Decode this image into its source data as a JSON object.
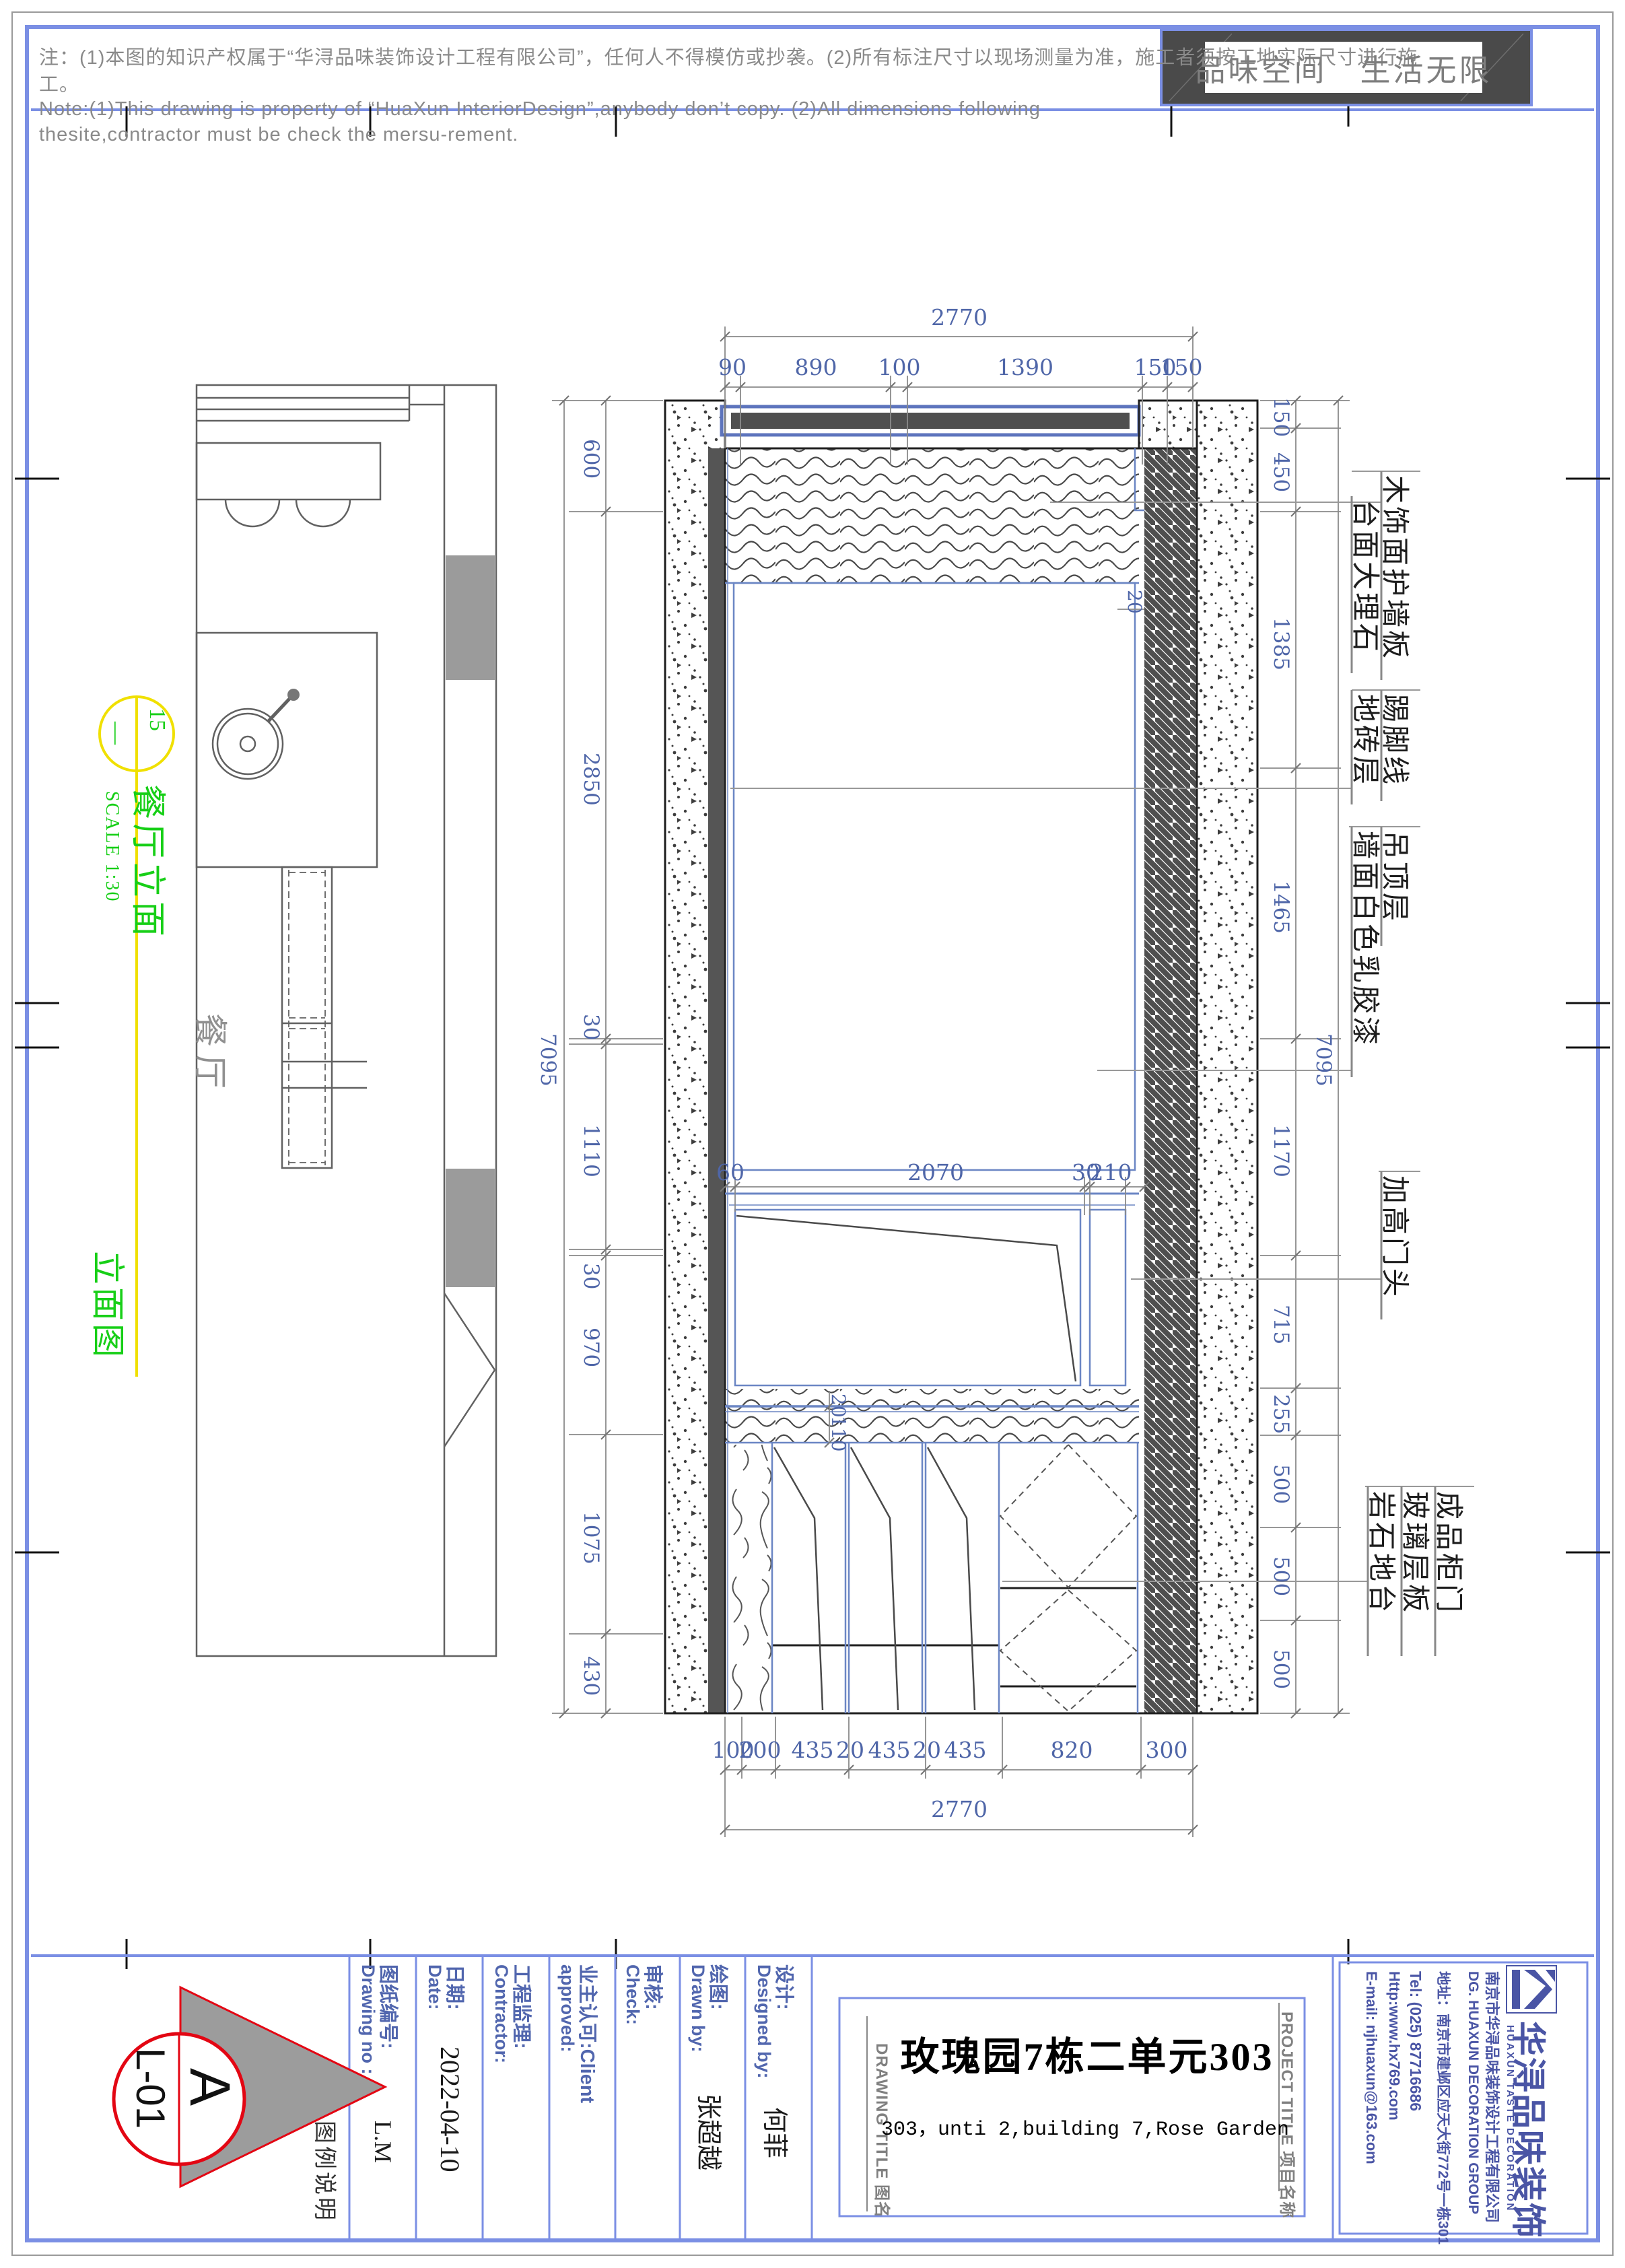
{
  "notes": {
    "line1": "注：(1)本图的知识产权属于“华浔品味装饰设计工程有限公司”，任何人不得模仿或抄袭。(2)所有标注尺寸以现场测量为准，施工者须按工地实际尺寸进行施",
    "line2": "工。",
    "line3": "Note:(1)This drawing is property of  “HuaXun InteriorDesign”,anybody don’t copy.   (2)All dimensions following",
    "line4": "thesite,contractor must be check the  mersu-rement."
  },
  "slogan": "品味空间　生活无限",
  "plan": {
    "room_label": "餐厅"
  },
  "marker": {
    "number": "15",
    "dash": "—",
    "title": "餐厅立面",
    "scale": "SCALE  1:30",
    "subtitle": "立面图"
  },
  "dims": {
    "top_total": "2770",
    "top": [
      "90",
      "890",
      "100",
      "1390",
      "150",
      "150"
    ],
    "bottom": [
      "100",
      "200",
      "435",
      "20",
      "435",
      "20",
      "435",
      "820",
      "300"
    ],
    "bottom_total": "2770",
    "left": [
      "600",
      "2850",
      "30",
      "1110",
      "30",
      "970",
      "1075",
      "430"
    ],
    "left_total": "7095",
    "right": [
      "150",
      "450",
      "1385",
      "1465",
      "1170",
      "715",
      "255",
      "500",
      "500",
      "500"
    ],
    "right_total": "7095",
    "mid": [
      "60",
      "2070",
      "30",
      "210"
    ],
    "small": [
      "20",
      "20",
      "110"
    ]
  },
  "labels": {
    "c1": [
      "木饰面护墙板",
      "台面大理石"
    ],
    "c2": [
      "踢脚线",
      "地砖层"
    ],
    "c3": [
      "吊顶层",
      "墙面白色乳胶漆"
    ],
    "c4": [
      "加高门头"
    ],
    "c5": [
      "成品柜门",
      "玻璃层板",
      "岩石地台"
    ]
  },
  "titleblock": {
    "legend": "图例说明",
    "logo_a": "A",
    "logo_code": "L-01",
    "fields": [
      {
        "cn": "图纸编号:",
        "en": "Drawing no :",
        "value": "L.M"
      },
      {
        "cn": "日期:",
        "en": "Date:",
        "value": "2022-04-10"
      },
      {
        "cn": "工程监理:",
        "en": "Contractor:",
        "value": ""
      },
      {
        "cn": "业主认可:Client",
        "en": "approved:",
        "value": ""
      },
      {
        "cn": "审核:",
        "en": "Check:",
        "value": ""
      },
      {
        "cn": "绘图:",
        "en": "Drawn by:",
        "value": "张超越"
      },
      {
        "cn": "设计:",
        "en": "Designed by:",
        "value": "何菲"
      }
    ],
    "drawing_title_tag": "DRAWING TITLE 图名",
    "project_title_tag": "PROJECT TITLE 项目名称",
    "title_cn": "玫瑰园7栋二单元303",
    "title_en": "303，unti 2,building 7,Rose Garden"
  },
  "company": {
    "logo_cn": "华浔品味装饰",
    "logo_en": "HUAXUN TASTE DECORATION",
    "line1": "南京市华浔品味装饰设计工程有限公司",
    "line2": "DG.  HUAXUN   DECORATION   GROUP",
    "line3": "地址：南京市建邺区应天大街772号一栋301",
    "line4": "Tel:  (025) 87716686",
    "line5": "Http:www.hx769.com",
    "line6": "E-mail: njhuaxun@163.com"
  },
  "colors": {
    "frame_blue": "#7b8fe4",
    "dim_blue": "#4f66a8",
    "cad_blue": "#6b86c4",
    "marker_yellow": "#f0e000",
    "marker_green": "#17cf17",
    "logo_red": "#e30613",
    "company_blue": "#4a55a5"
  }
}
